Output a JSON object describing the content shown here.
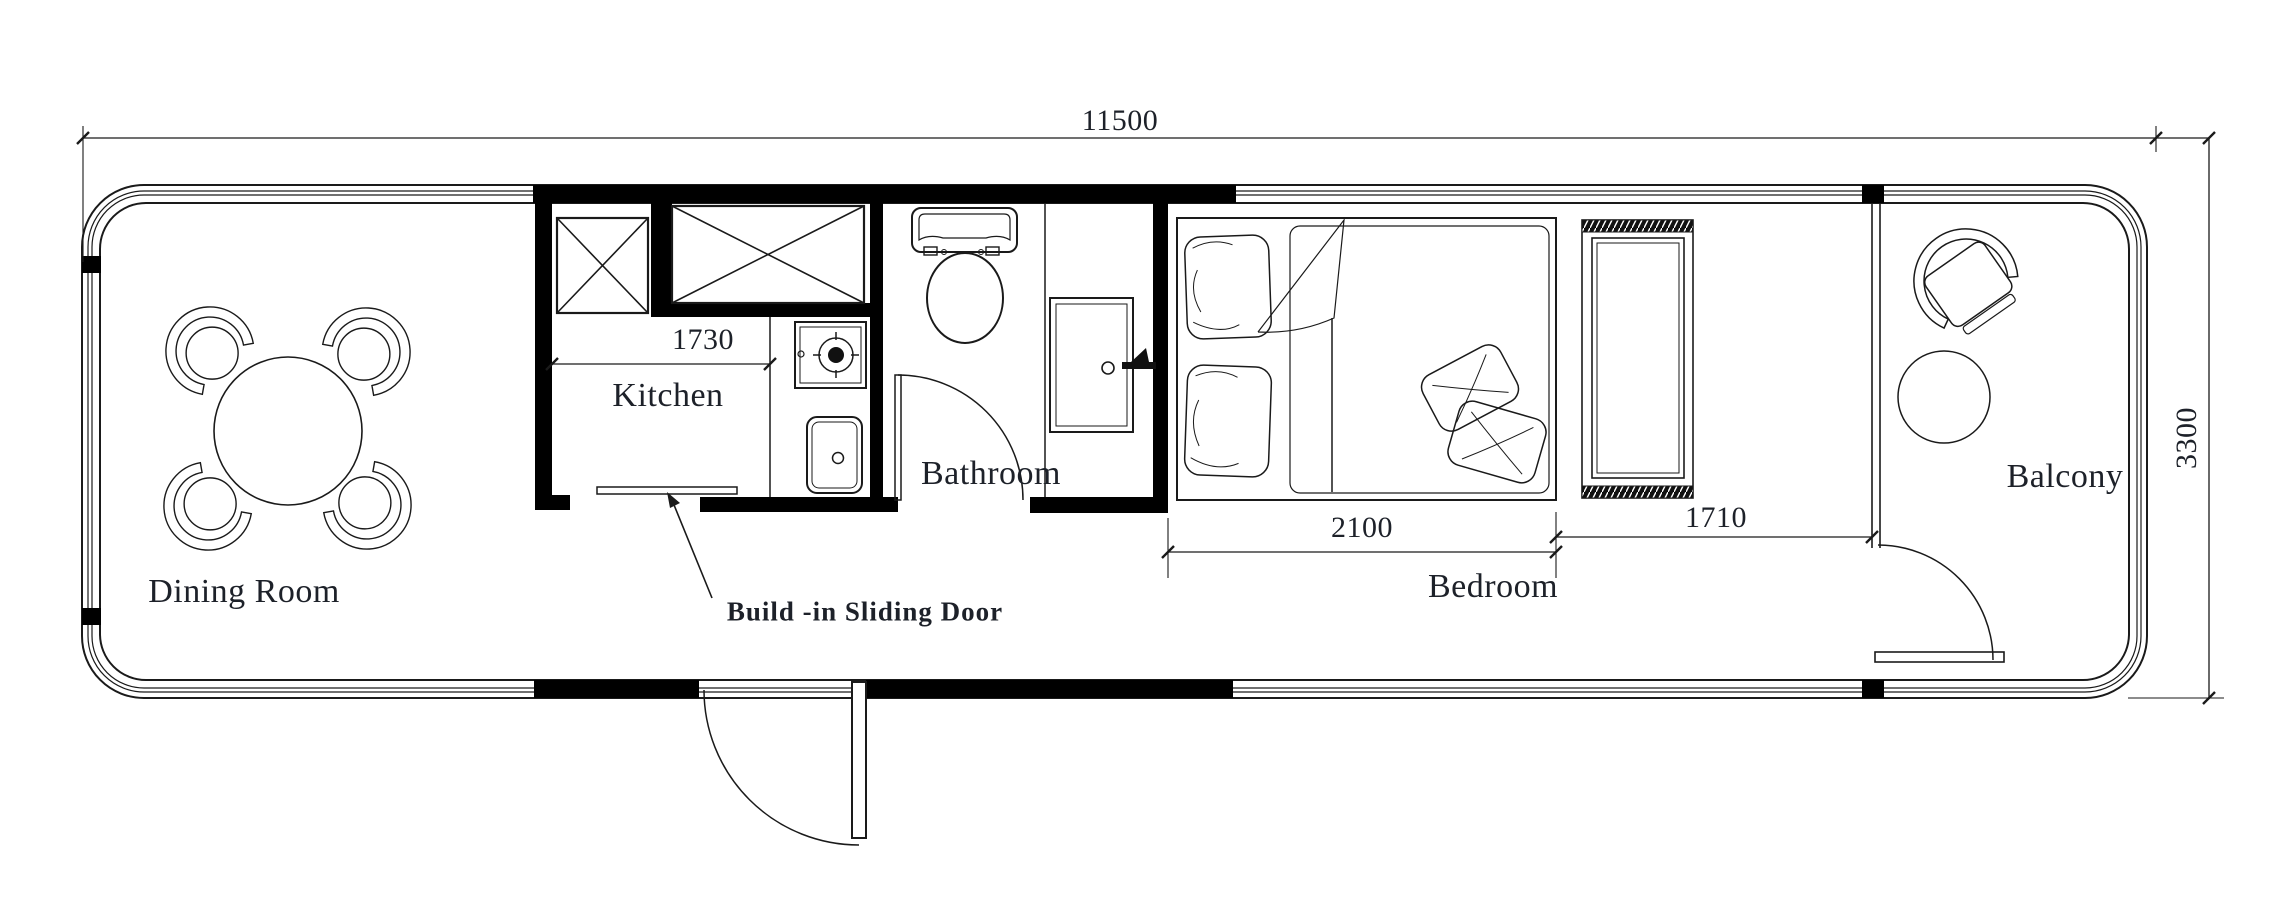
{
  "drawing": {
    "type": "architectural floor plan",
    "units": "mm"
  },
  "labels": {
    "dining_room": "Dining Room",
    "kitchen": "Kitchen",
    "bathroom": "Bathroom",
    "bedroom": "Bedroom",
    "balcony": "Balcony",
    "sliding_door_note": "Build -in Sliding Door"
  },
  "dimensions": {
    "total_length": "11500",
    "total_width": "3300",
    "kitchen_width": "1730",
    "bed_length": "2100",
    "wardrobe_zone": "1710"
  },
  "colors": {
    "background": "#ffffff",
    "line": "#1a1a1a",
    "wall_fill": "#000000",
    "text": "#1d2129"
  }
}
